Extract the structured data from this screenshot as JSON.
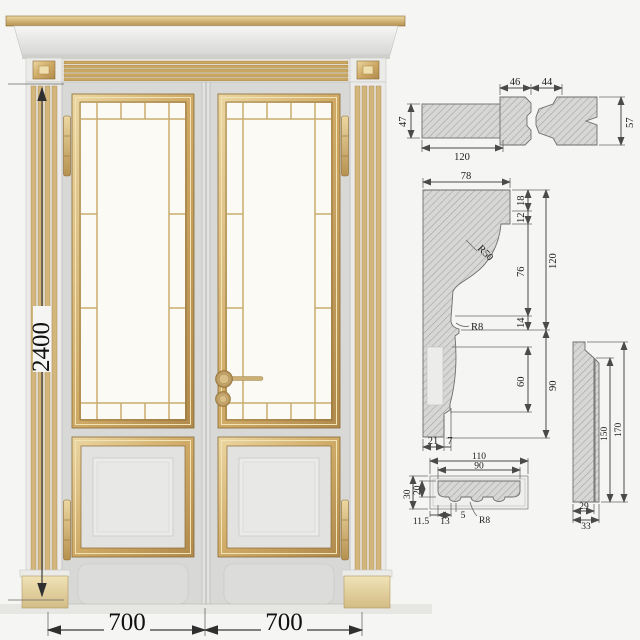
{
  "door": {
    "height_dim": "2400",
    "leaf_left_dim": "700",
    "leaf_right_dim": "700"
  },
  "sections": {
    "jamb": {
      "top_dim_a": "46",
      "top_dim_b": "44",
      "left_dim": "47",
      "bottom_dim": "120",
      "right_dim": "57"
    },
    "crown": {
      "top_dim": "78",
      "chain_1": "18",
      "chain_2": "12",
      "chain_3": "76",
      "chain_4": "14",
      "overall_dim": "120",
      "inner_dim": "60",
      "lower_overall_dim": "90",
      "bottom_a": "21",
      "bottom_b": "7",
      "radius_large": "R50",
      "radius_small": "R8"
    },
    "casing": {
      "top_outer": "110",
      "top_inner": "90",
      "left_outer": "30",
      "left_inner": "20",
      "bottom_a": "11.5",
      "bottom_b": "13",
      "bottom_c": "5",
      "radius": "R8"
    },
    "plinth": {
      "right_inner": "150",
      "right_outer": "170",
      "bottom_inner": "29",
      "bottom_outer": "33"
    }
  },
  "colors": {
    "gold": "#c9a25f",
    "gold_light": "#ecd7a2",
    "gold_dark": "#8a6a34",
    "leaf_gray": "#d8d8d6",
    "crown_white": "#efefed",
    "glass": "#fbfaf5",
    "hatch_bg": "#d7d7d5",
    "dimension": "#4a4a4a"
  }
}
